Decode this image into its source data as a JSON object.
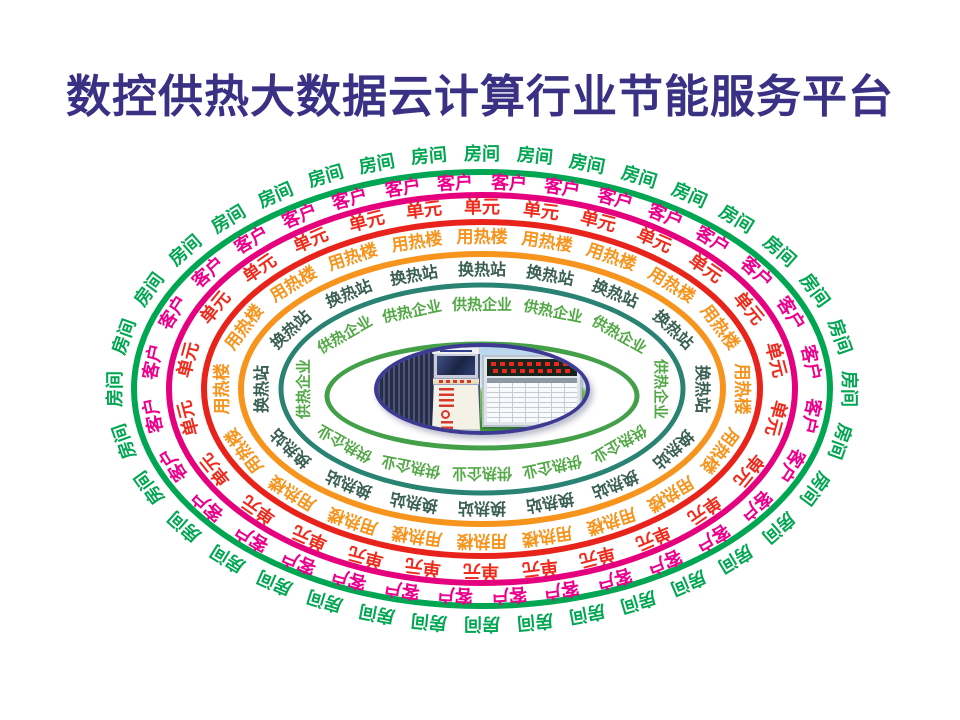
{
  "title": {
    "text": "数控供热大数据云计算行业节能服务平台",
    "color": "#3A3185"
  },
  "center": {
    "cx": 482,
    "cy": 389
  },
  "rings": [
    {
      "name": "room",
      "label": "房间",
      "count": 36,
      "phase": 0,
      "text_color": "#00A651",
      "line_color": "#00A651",
      "text_rx": 366,
      "text_ry": 234,
      "line_rx": 348,
      "line_ry": 217,
      "font_size": 18,
      "line_width": 6,
      "line_dy": 0
    },
    {
      "name": "customer",
      "label": "客户",
      "count": 32,
      "phase": 0.5,
      "text_color": "#EC008C",
      "line_color": "#E5007E",
      "text_rx": 331,
      "text_ry": 206,
      "line_rx": 313,
      "line_ry": 194,
      "font_size": 18,
      "line_width": 6,
      "line_dy": 0
    },
    {
      "name": "unit",
      "label": "单元",
      "count": 26,
      "phase": 0,
      "text_color": "#EF2B1E",
      "line_color": "#E8231C",
      "text_rx": 297,
      "text_ry": 181,
      "line_rx": 278,
      "line_ry": 167,
      "font_size": 18,
      "line_width": 6,
      "line_dy": 0
    },
    {
      "name": "heat-building",
      "label": "用热楼",
      "count": 20,
      "phase": 0,
      "text_color": "#F7941D",
      "line_color": "#F7941D",
      "text_rx": 259,
      "text_ry": 151,
      "line_rx": 241,
      "line_ry": 135,
      "font_size": 17,
      "line_width": 6,
      "line_dy": 0
    },
    {
      "name": "heat-exchange-station",
      "label": "换热站",
      "count": 16,
      "phase": 0,
      "text_color": "#3A5F53",
      "line_color": "#2A8372",
      "text_rx": 220,
      "text_ry": 119,
      "line_rx": 201,
      "line_ry": 104,
      "font_size": 16,
      "line_width": 5,
      "line_dy": 0
    },
    {
      "name": "heat-supply-enterprise",
      "label": "供热企业",
      "count": 12,
      "phase": 0,
      "text_color": "#52A846",
      "line_color": "#44A048",
      "text_rx": 178,
      "text_ry": 84,
      "line_rx": 155,
      "line_ry": 52,
      "font_size": 15,
      "line_width": 5,
      "line_dy": 7
    }
  ],
  "hub": {
    "colors": {
      "border": "#3D3A94",
      "sky_top": "#b7d5ec",
      "sky_low": "#ddebf7",
      "grass_top": "#84c65a",
      "grass_bottom": "#3f9e3e",
      "curtain_dark": "#262c49",
      "curtain_light": "#4d5574",
      "led_red": "#e8281e",
      "screen": "#1a2342",
      "kiosk_red": "#d8392b",
      "kiosk_body": "#f4f2e7"
    }
  }
}
